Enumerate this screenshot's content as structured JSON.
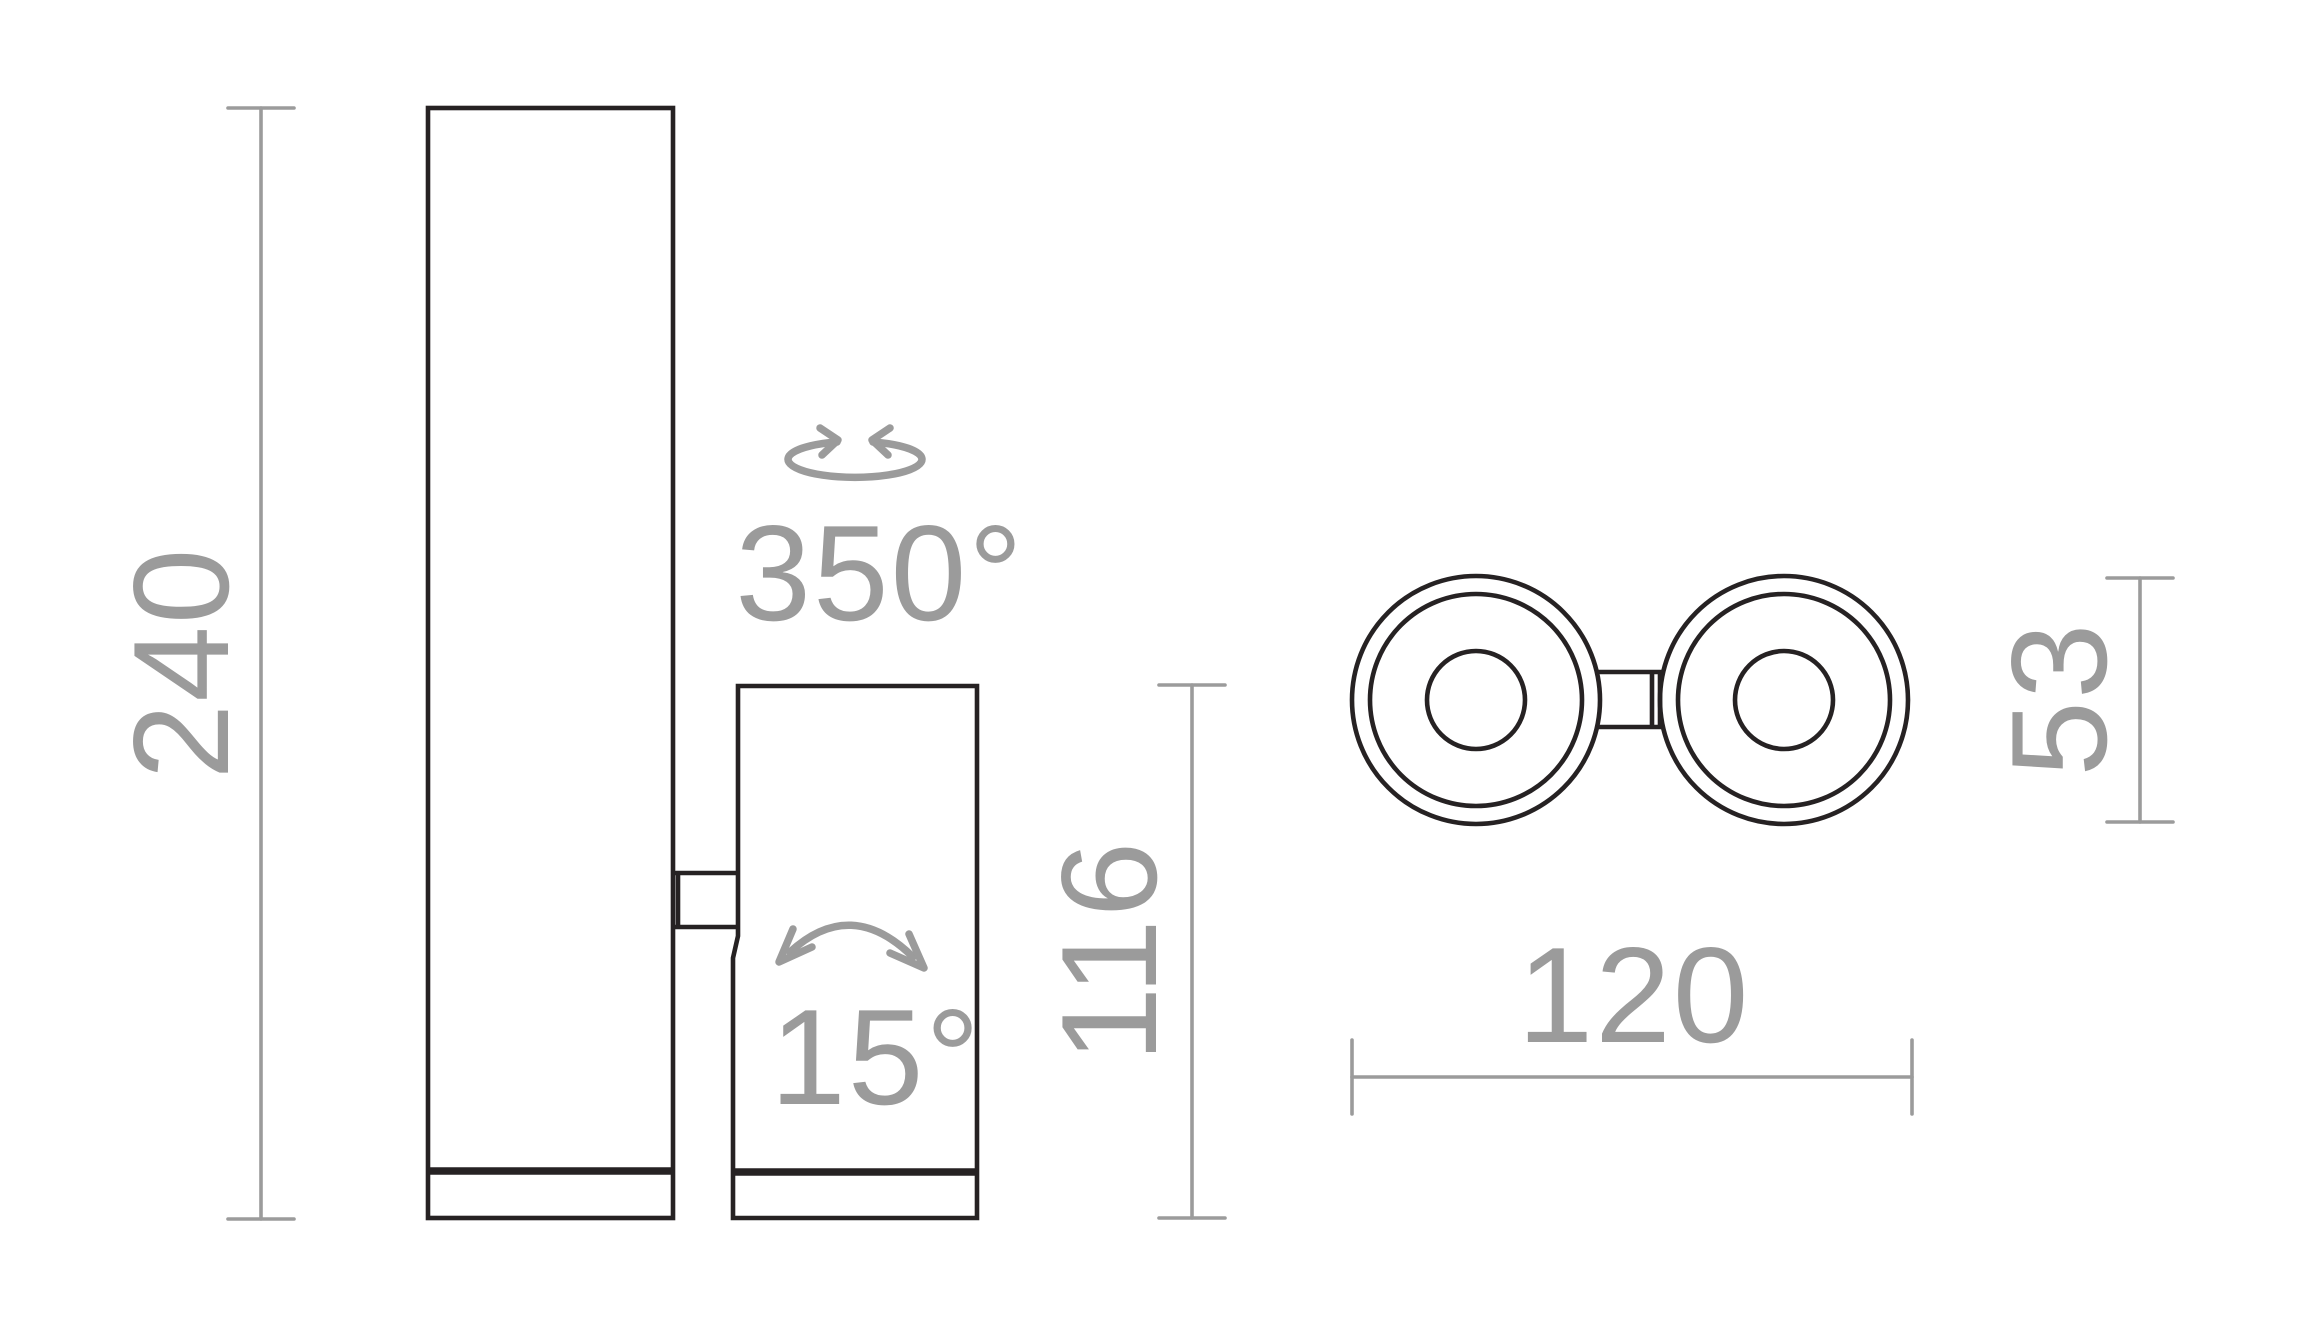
{
  "drawing": {
    "front_view": {
      "overall_height_mm": "240",
      "head_height_mm": "116",
      "swivel_angle": "350°",
      "tilt_angle": "15°"
    },
    "top_view": {
      "overall_width_mm": "120",
      "head_diameter_mm": "53"
    },
    "colors": {
      "outline": "#262223",
      "dimension_gray": "#9b9b9b"
    },
    "icons": [
      "rotation-arrows-icon",
      "tilt-arc-icon"
    ]
  }
}
